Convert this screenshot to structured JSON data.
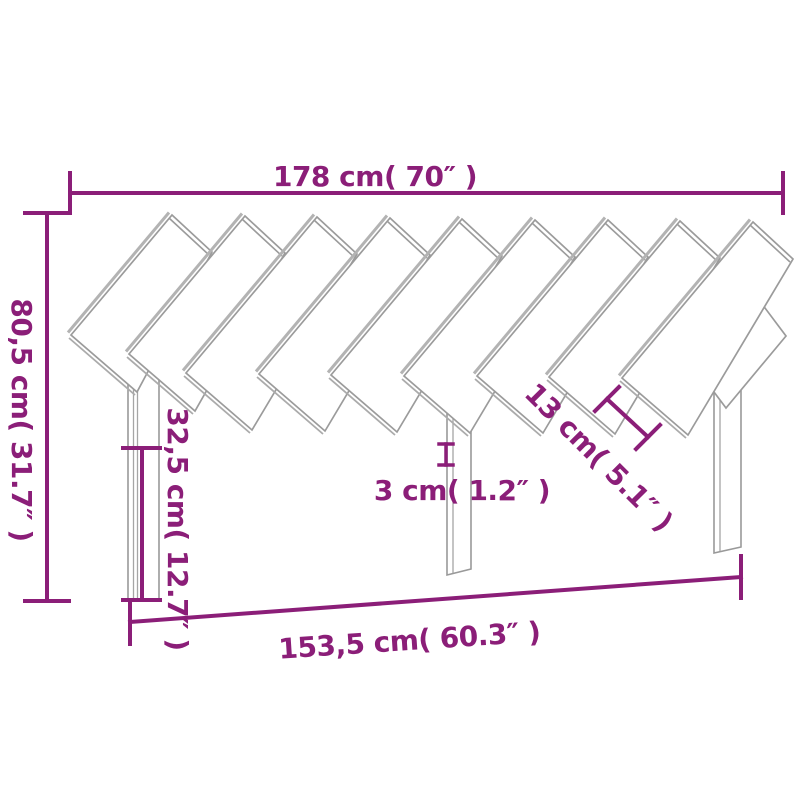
{
  "drawing": {
    "title": "headboard-dimension-diagram",
    "dimensions": {
      "total_width": "178 cm( 70″ )",
      "total_height": "80,5 cm( 31.7″ )",
      "panel_height": "32,5 cm( 12.7″ )",
      "leg_thickness": "3 cm( 1.2″ )",
      "slat_width": "13 cm( 5.1″ )",
      "base_width": "153,5 cm( 60.3″ )"
    },
    "colors": {
      "dimension_accent": "#8b1e78",
      "outline_gray": "#9b9b9b",
      "background": "#ffffff"
    }
  }
}
